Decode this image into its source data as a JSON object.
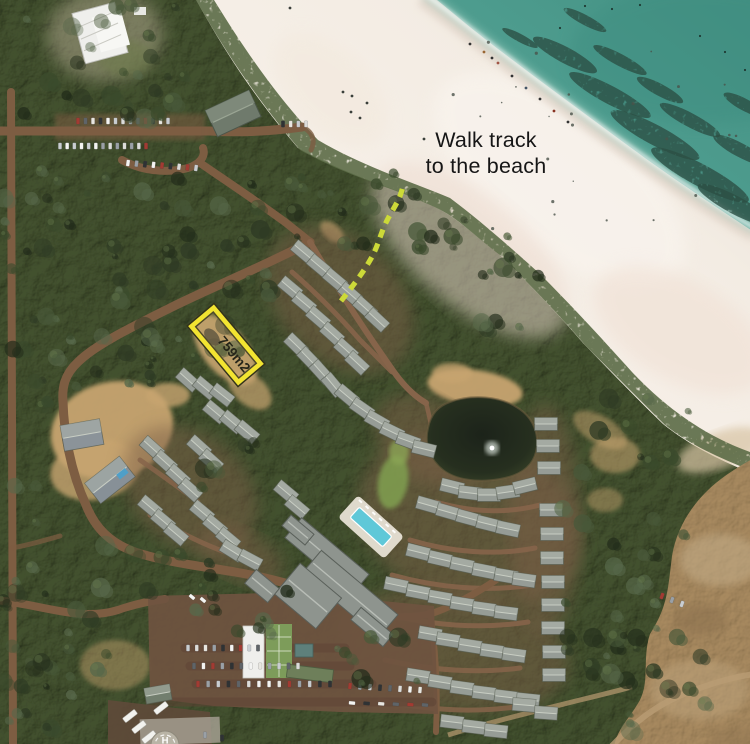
{
  "annotations": {
    "walk_track_label": {
      "line1": "Walk track",
      "line2": "to the beach"
    },
    "lot_area_label": "759m2",
    "helipad_letter": "H"
  },
  "scene": {
    "highlight_yellow": "#f2e431",
    "highlight_outline": "#33331a",
    "lot_fill": "rgba(210,175,110,0.18)",
    "track_green": "#ccd938",
    "label_text": "#161616",
    "lot_label_text": "#26261a",
    "ocean_deep": "#449183",
    "ocean_mid": "#4f9e90",
    "ocean_shallow": "#a8cfc2",
    "sand_bright": "#f6efe7",
    "sand_wet": "#e0d2c6",
    "sand_pink": "#ecd9cd",
    "forest": "#43512f",
    "field": "#a7895f",
    "pond": "#242c1e",
    "pool": "#5fc8d8",
    "road": "#7d5d42",
    "street": "#86644a",
    "roof_gray": "#969c96",
    "roof_white": "#efefec",
    "lawn": "#7f9c50"
  }
}
